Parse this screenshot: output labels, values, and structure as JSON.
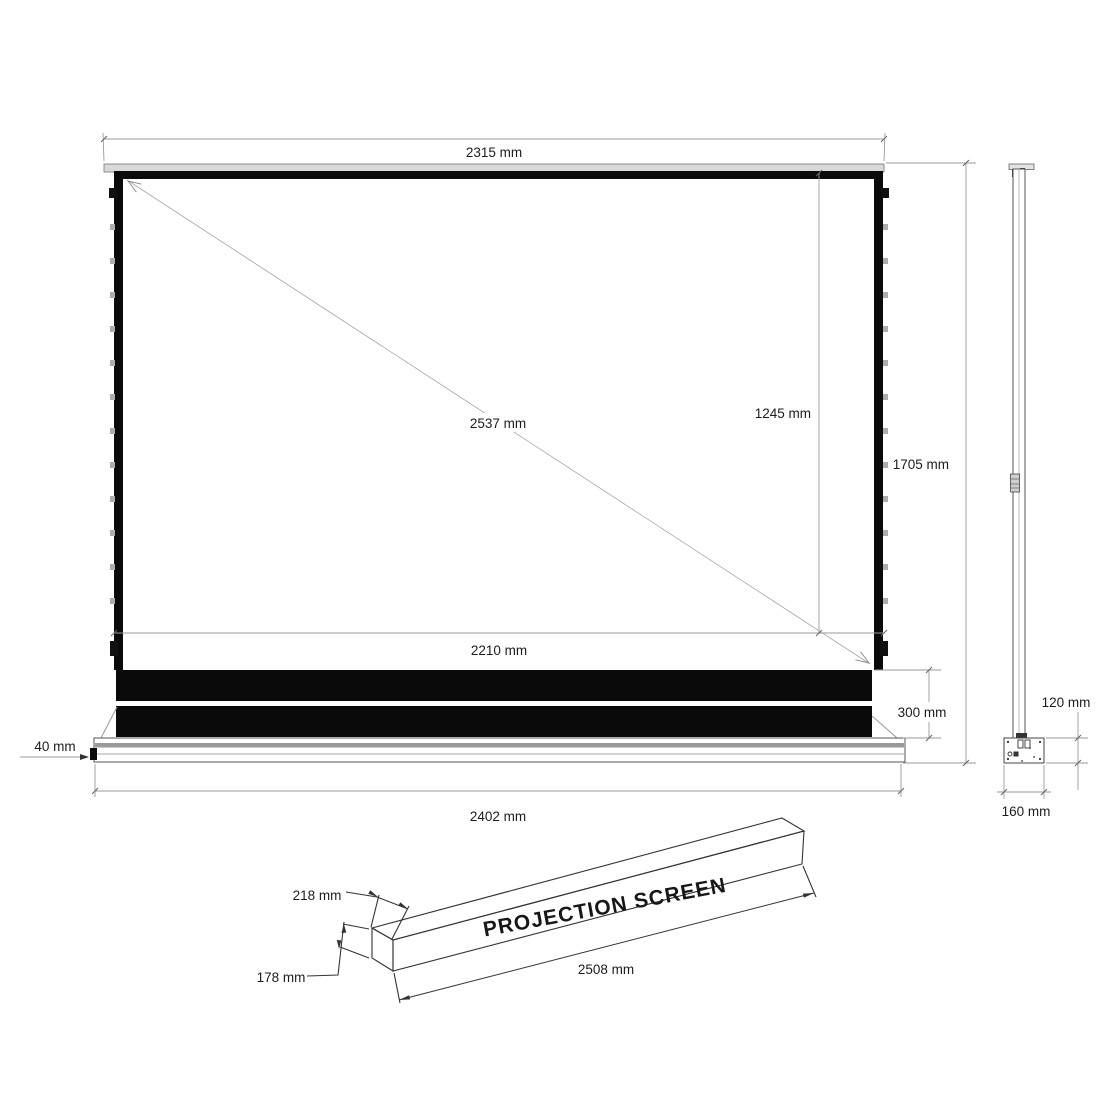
{
  "drawing_title": "Projection screen dimension drawing",
  "front_view": {
    "top_width_label": "2315 mm",
    "diagonal_label": "2537 mm",
    "viewing_height_label": "1245 mm",
    "total_height_label": "1705 mm",
    "viewing_width_label": "2210 mm",
    "housing_height_label": "300 mm",
    "foot_height_label": "40 mm",
    "base_width_label": "2402 mm"
  },
  "side_view": {
    "pole_depth_label": "120 mm",
    "base_depth_label": "160 mm"
  },
  "case_view": {
    "case_text": "PROJECTION SCREEN",
    "case_depth_label": "218 mm",
    "case_height_label": "178 mm",
    "case_length_label": "2508 mm"
  },
  "colors": {
    "background": "#ffffff",
    "object_black": "#0a0a0a",
    "object_line": "#333333",
    "dimension_line": "#9a9a9a",
    "text": "#1c1c1c",
    "slat_gray": "#d9d9d9",
    "base_band_gray": "#9b9b9b",
    "tab_gray": "#adadad"
  }
}
